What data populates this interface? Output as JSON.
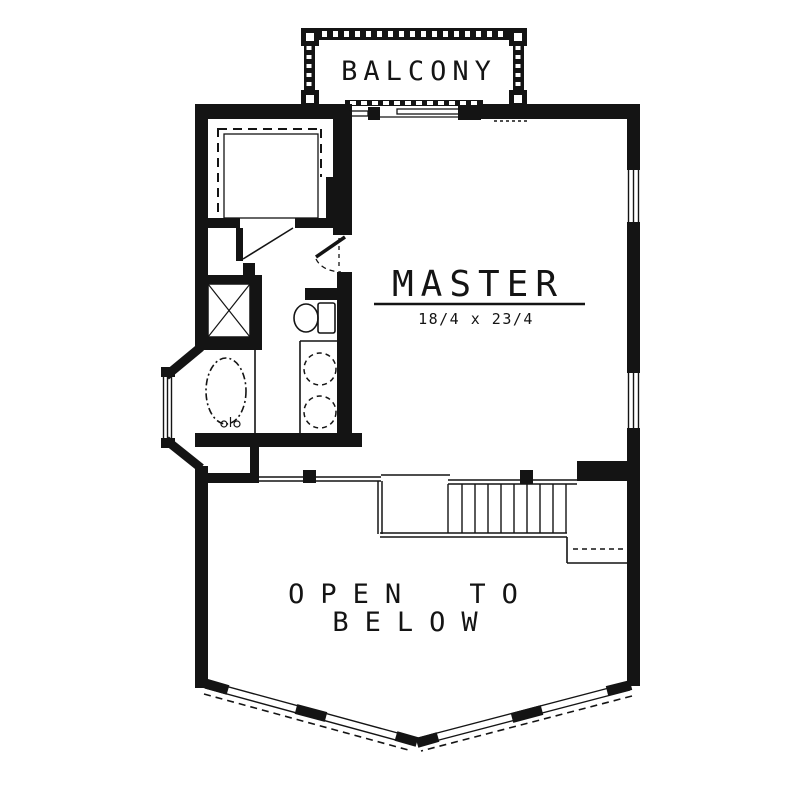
{
  "floorplan": {
    "colors": {
      "ink": "#141414",
      "paper": "#ffffff"
    },
    "labels": {
      "balcony": "BALCONY",
      "master": "MASTER",
      "master_dims": "18/4 x 23/4",
      "open_below_line1": "OPEN TO",
      "open_below_line2": "BELOW"
    },
    "fixtures": [
      "balcony-rail",
      "sliding-glass-door",
      "walk-in-closet-shelves",
      "shower-stall",
      "garden-tub-bay",
      "toilet",
      "double-vanity-sinks",
      "swing-door-closet",
      "swing-door-master-bath",
      "stairs",
      "stair-landing",
      "open-to-below-railing",
      "prow-window-wall",
      "window-right-upper",
      "window-right-lower",
      "bay-window"
    ]
  }
}
